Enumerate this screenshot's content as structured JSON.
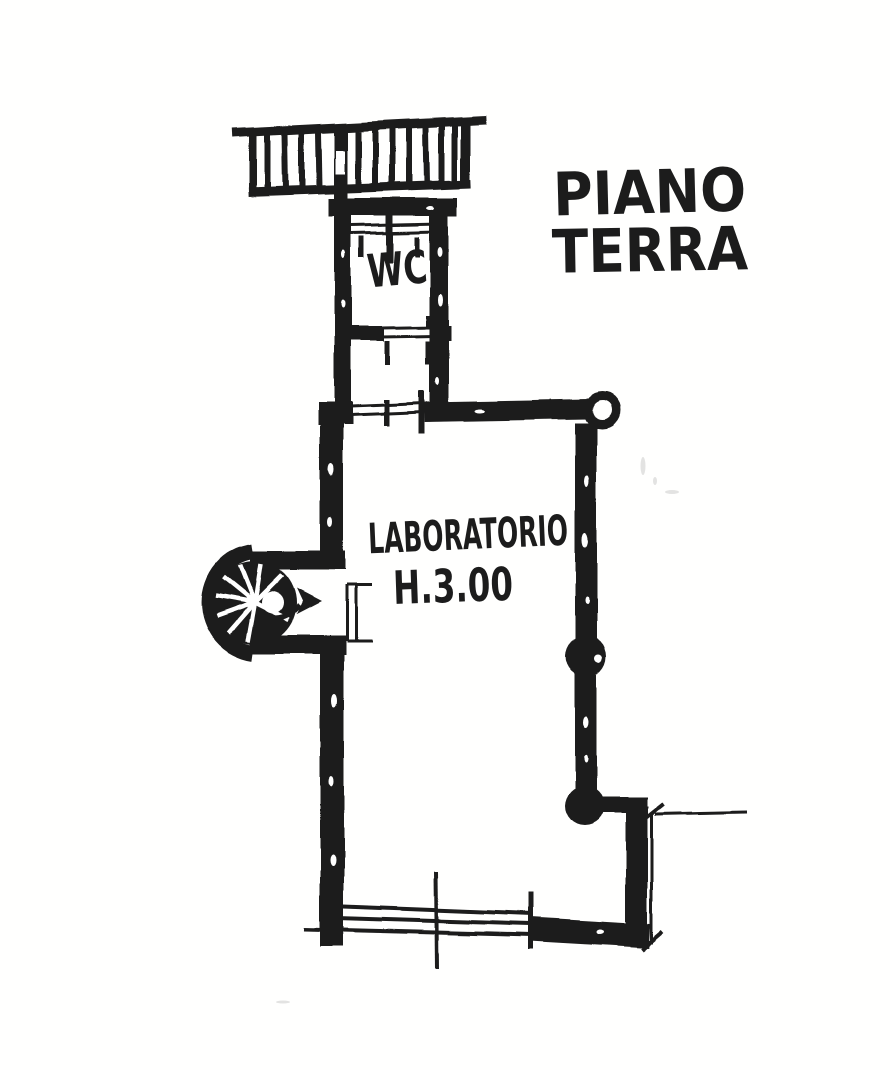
{
  "plan": {
    "title": {
      "line1": "PIANO",
      "line2": "TERRA"
    },
    "rooms": {
      "wc_label": "WC",
      "laboratory_label": "LABORATORIO",
      "laboratory_height_note": "H.3.00"
    },
    "colors": {
      "ink": "#1c1c1c",
      "paper": "#ffffff"
    }
  }
}
